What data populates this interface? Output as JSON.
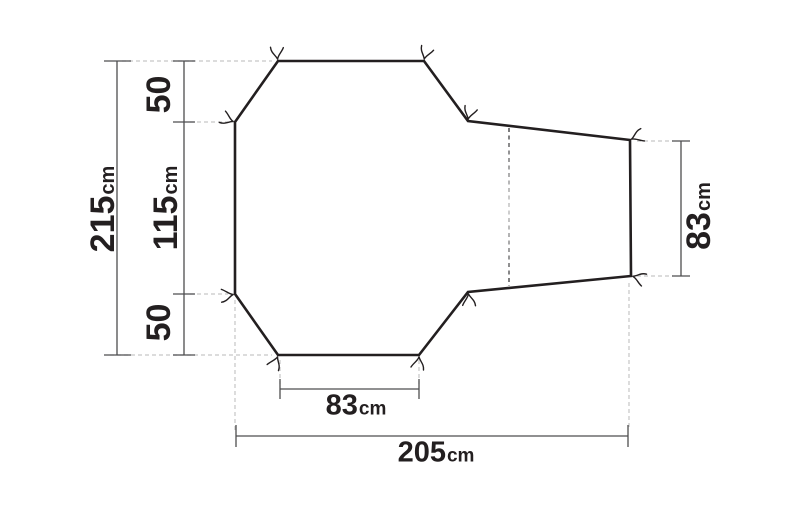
{
  "diagram": {
    "type": "tent-footprint-dimension-diagram",
    "measurement_unit": "cm",
    "labels": {
      "left_total": {
        "value": "215",
        "unit": "cm"
      },
      "left_top_segment": {
        "value": "50",
        "unit": ""
      },
      "left_middle_segment": {
        "value": "115",
        "unit": "cm"
      },
      "left_bottom_segment": {
        "value": "50",
        "unit": ""
      },
      "right_height": {
        "value": "83",
        "unit": "cm"
      },
      "bottom_inner_width": {
        "value": "83",
        "unit": "cm"
      },
      "bottom_total_width": {
        "value": "205",
        "unit": "cm"
      }
    },
    "tie_out_points": 10
  },
  "colors": {
    "outline": "#231f20",
    "dimension_line": "#4d4d4f",
    "extension_line": "#c6c6c6",
    "fold_line_dark": "#3d3d3f",
    "fold_line_light": "#c2c2c2",
    "text": "#231f20",
    "background": "#ffffff"
  }
}
